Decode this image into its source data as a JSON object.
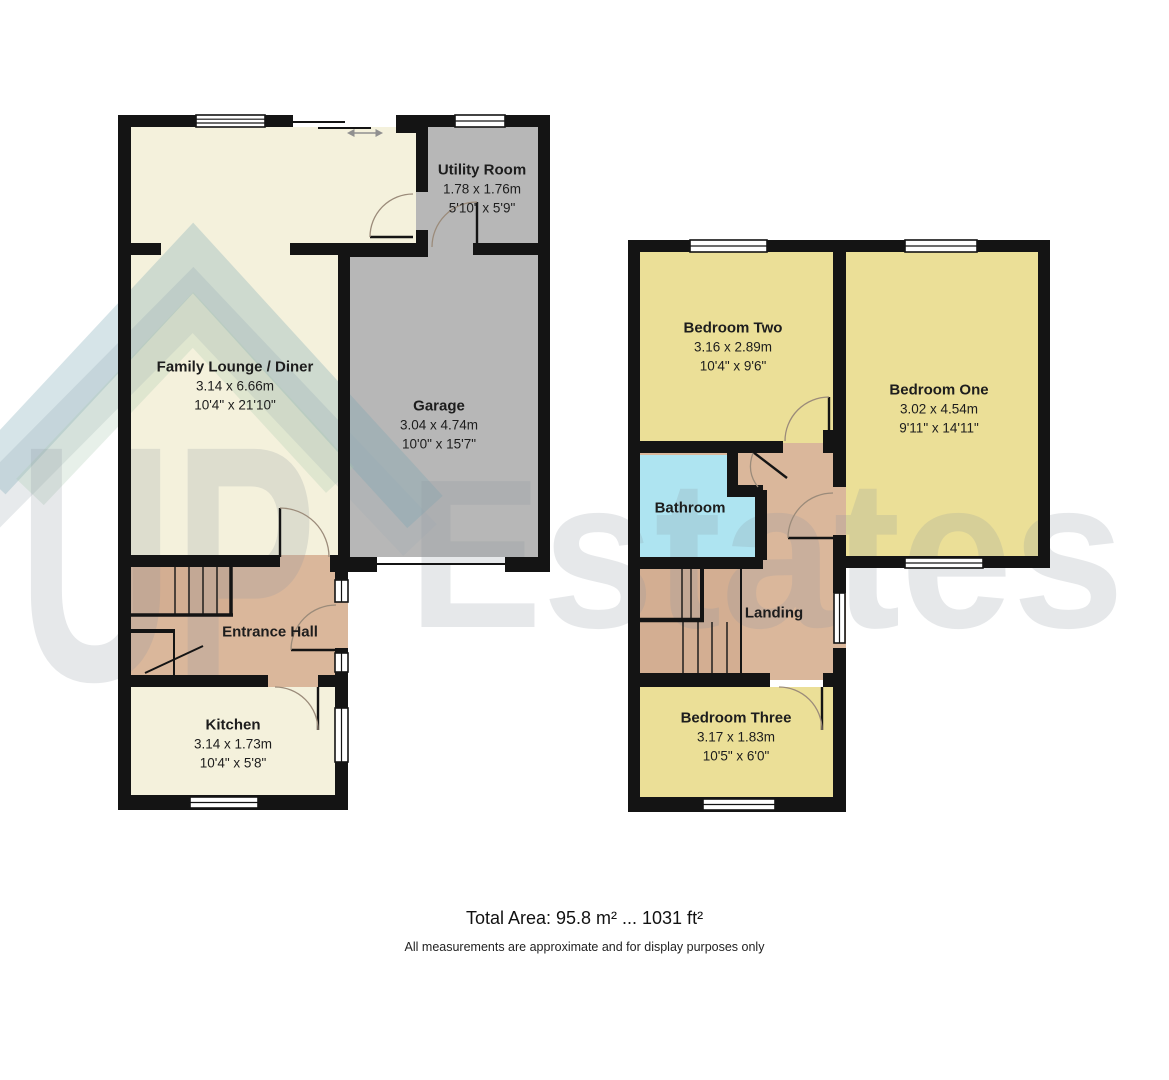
{
  "watermark": {
    "brand_first": "UP",
    "brand_second": "Estates"
  },
  "floors": {
    "ground": {
      "rooms": [
        {
          "id": "utility",
          "name": "Utility Room",
          "metric": "1.78 x 1.76m",
          "imperial": "5'10\" x 5'9\""
        },
        {
          "id": "lounge",
          "name": "Family Lounge / Diner",
          "metric": "3.14 x 6.66m",
          "imperial": "10'4\" x 21'10\""
        },
        {
          "id": "garage",
          "name": "Garage",
          "metric": "3.04 x 4.74m",
          "imperial": "10'0\" x 15'7\""
        },
        {
          "id": "entrance-hall",
          "name": "Entrance Hall"
        },
        {
          "id": "kitchen",
          "name": "Kitchen",
          "metric": "3.14 x 1.73m",
          "imperial": "10'4\" x 5'8\""
        }
      ]
    },
    "first": {
      "rooms": [
        {
          "id": "bedroom-two",
          "name": "Bedroom Two",
          "metric": "3.16 x 2.89m",
          "imperial": "10'4\" x 9'6\""
        },
        {
          "id": "bedroom-one",
          "name": "Bedroom One",
          "metric": "3.02 x 4.54m",
          "imperial": "9'11\" x 14'11\""
        },
        {
          "id": "bathroom",
          "name": "Bathroom"
        },
        {
          "id": "landing",
          "name": "Landing"
        },
        {
          "id": "bedroom-three",
          "name": "Bedroom Three",
          "metric": "3.17 x 1.83m",
          "imperial": "10'5\" x 6'0\""
        }
      ]
    }
  },
  "footer": {
    "total_area": "Total Area: 95.8 m² ... 1031 ft²",
    "disclaimer": "All measurements are approximate and for display purposes only"
  },
  "colors": {
    "wall": "#141414",
    "cream_room": "#f4f1dc",
    "grey_room": "#b7b7b7",
    "tan_room": "#dab79b",
    "stairs_tan": "#d3ae92",
    "yellow_room": "#ebdf97",
    "cyan_room": "#aee4f1",
    "window_white": "#ffffff"
  }
}
